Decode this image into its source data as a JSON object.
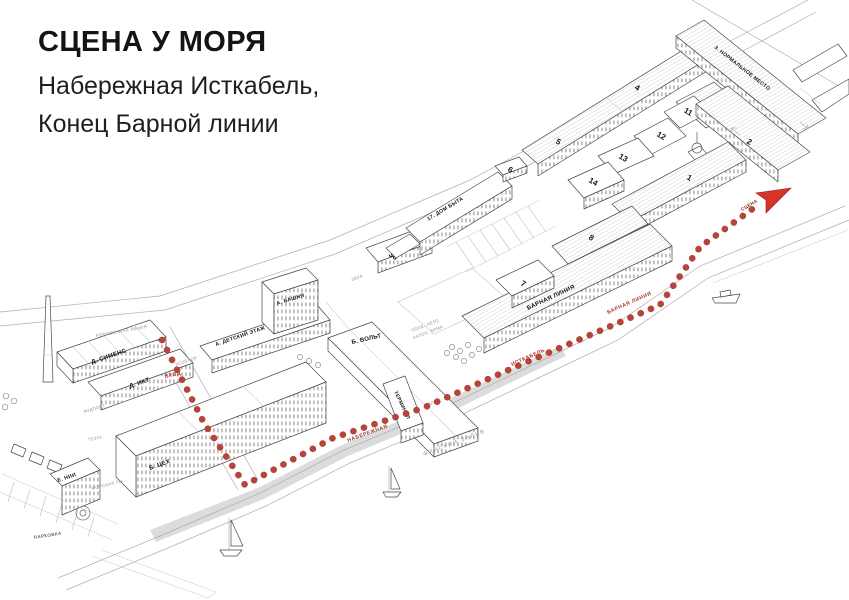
{
  "title": {
    "heading": "СЦЕНА У МОРЯ",
    "address_line_1": "Набережная Исткабель,",
    "address_line_2": "Конец Барной линии"
  },
  "map": {
    "buildings": {
      "siemens": "Д. СИМЕНС",
      "ikt": "Д. ИКТ",
      "detskiy_etazh": "А. ДЕТСКИЙ ЭТАЖ",
      "bashnya": "А. БАШНЯ",
      "volt": "Б. ВОЛЬТ",
      "tseh": "Б. ЦЕХ",
      "nii": "Е. НИИ",
      "terminal": "ТЕРМИНАЛ",
      "dom_byta": "17. ДОМ БЫТА",
      "normalnoe_mesto": "3. НОРМАЛЬНОЕ МЕСТО",
      "barnaya_liniya": "БАРНАЯ ЛИНИЯ",
      "n1": "1",
      "n2": "2",
      "n4": "4",
      "n5": "5",
      "n6": "6",
      "n7": "7",
      "n8": "8",
      "n10": "10",
      "n11": "11",
      "n12": "12",
      "n13": "13",
      "n14": "14",
      "n36": "36"
    },
    "streets": {
      "kozhevennaya": "КОЖЕВЕННАЯ ЛИНИЯ",
      "morskaya": "МОРСКАЯ ЛН.",
      "parkovka": "ПАРКОВКА",
      "gulf": "ФИНСКИЙ ЗАЛИВ",
      "pole_leto": "ПОЛЕ: ЛЕТО",
      "katok_zima": "КАТОК: ЗИМА",
      "plyazh": "ПЛЯЖ"
    },
    "small_labels": {
      "hozblok": "ХОЗБЛОК",
      "fudport": "ФУДПОРТ",
      "tezga": "ТЕЗГА",
      "zvuk": "ЗВУК"
    },
    "route": {
      "entrance": "ВХОД",
      "embankment": "НАБЕРЕЖНАЯ",
      "istkabel": "ИСТКАБЕЛЬ",
      "bar_line": "БАРНАЯ ЛИНИЯ",
      "stage": "СЦЕНА",
      "dot_color": "#b5443a",
      "arrow_color": "#d63529",
      "label_color": "#a5392f"
    }
  }
}
